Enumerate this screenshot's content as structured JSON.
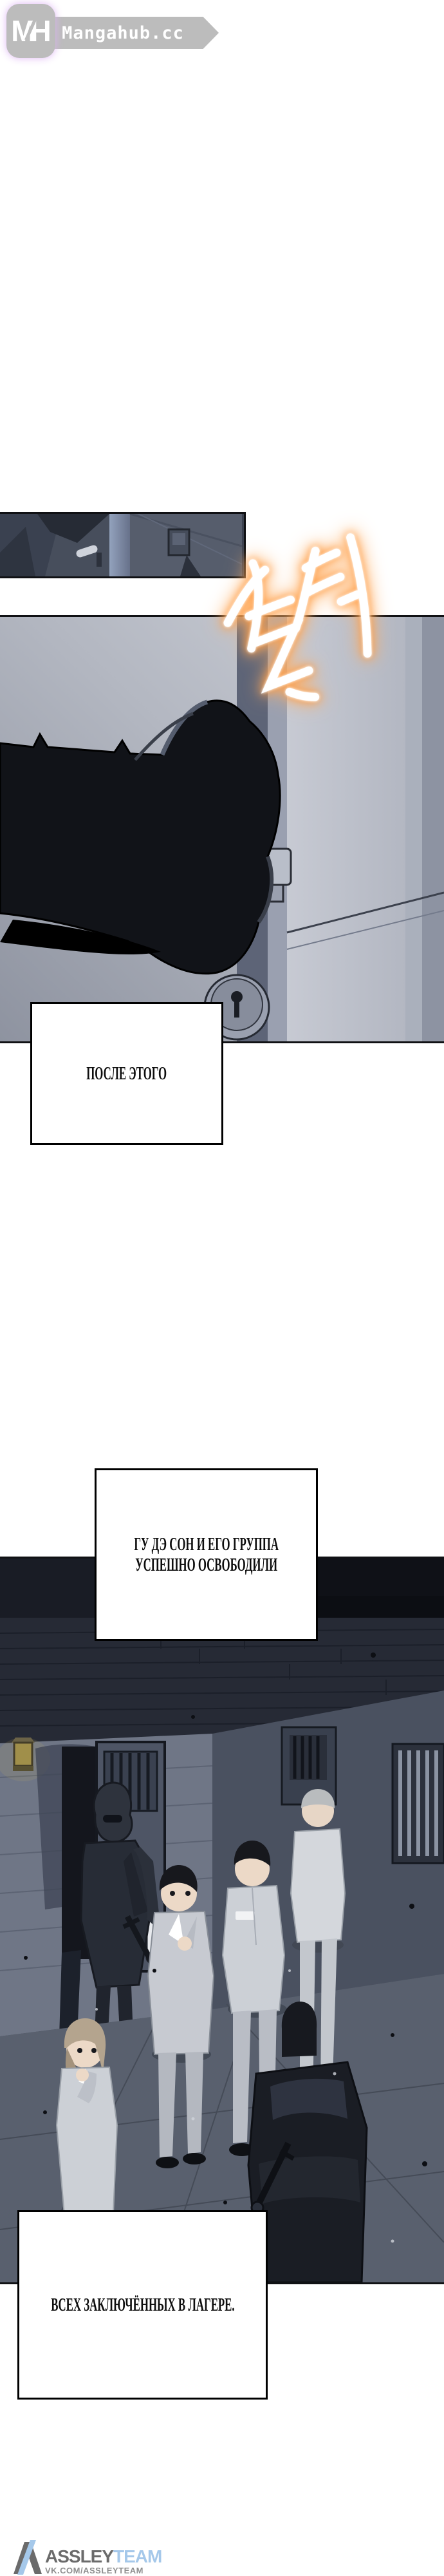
{
  "header": {
    "logo_monogram": "MH",
    "site_name": "Mangahub.cc"
  },
  "sfx": {
    "text": "철커",
    "style": "hand-brushed korean sound effect, white with orange glow",
    "fill_color": "#ffffff",
    "glow_color": "#ff9a40"
  },
  "captions": [
    {
      "id": "caption-1",
      "text": "ПОСЛЕ ЭТОГО"
    },
    {
      "id": "caption-2",
      "line1": "ГУ ДЭ СОН И ЕГО ГРУППА",
      "line2": "УСПЕШНО ОСВОБОДИЛИ"
    },
    {
      "id": "caption-3",
      "text": "ВСЕХ ЗАКЛЮЧЁННЫХ В ЛАГЕРЕ."
    }
  ],
  "panels": [
    {
      "id": "panel-doors",
      "alt": "narrow panel: dark cell doors seen at an angle"
    },
    {
      "id": "panel-hand",
      "alt": "black gauntleted arm gripping a vertical door handle, keyhole plate below"
    },
    {
      "id": "panel-corridor",
      "alt": "prison corridor: armored guards opening cells, freed prisoners in gray uniforms walking"
    }
  ],
  "footer": {
    "team_name_primary": "ASSLEY",
    "team_name_accent": "TEAM",
    "team_url": "VK.COM/ASSLEYTEAM",
    "primary_color": "#6b6b6b",
    "accent_color": "#a5c8ea"
  }
}
